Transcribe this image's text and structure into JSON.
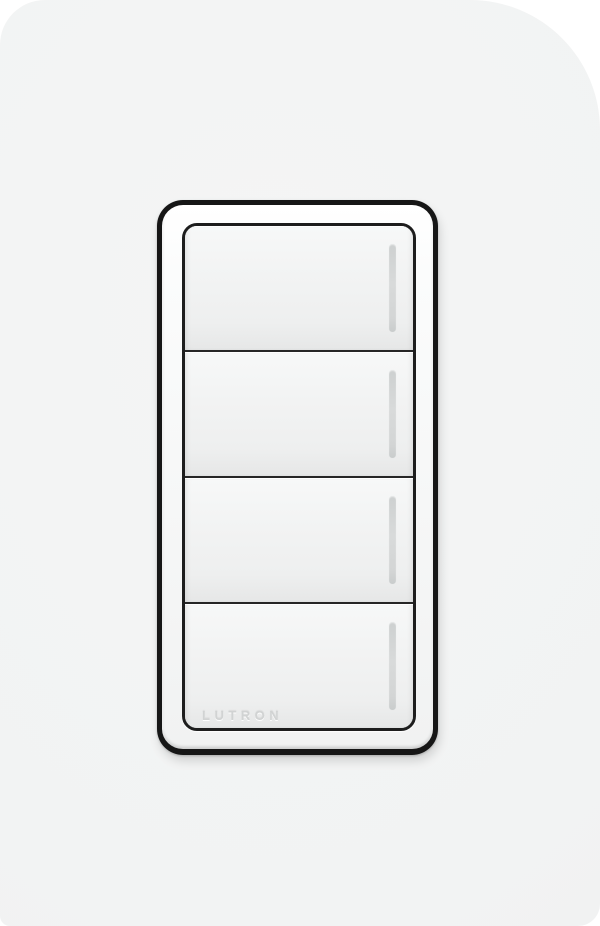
{
  "page": {
    "background_color": "#ffffff"
  },
  "wall": {
    "color": "#f2f3f3"
  },
  "device": {
    "name": "Lutron 4-button keypad light switch",
    "brand_label": "LUTRON",
    "bezel_color": "#161616",
    "faceplate_color": "#f9fafa",
    "button_color": "#f0f1f1",
    "separator_color": "#262626",
    "led_color": "#d4d6d6",
    "engraving_color": "#d1d3d3",
    "buttons": [
      {
        "position": 1,
        "label": "",
        "has_led_indicator": true
      },
      {
        "position": 2,
        "label": "",
        "has_led_indicator": true
      },
      {
        "position": 3,
        "label": "",
        "has_led_indicator": true
      },
      {
        "position": 4,
        "label": "",
        "has_led_indicator": true,
        "engraving": "LUTRON"
      }
    ]
  }
}
